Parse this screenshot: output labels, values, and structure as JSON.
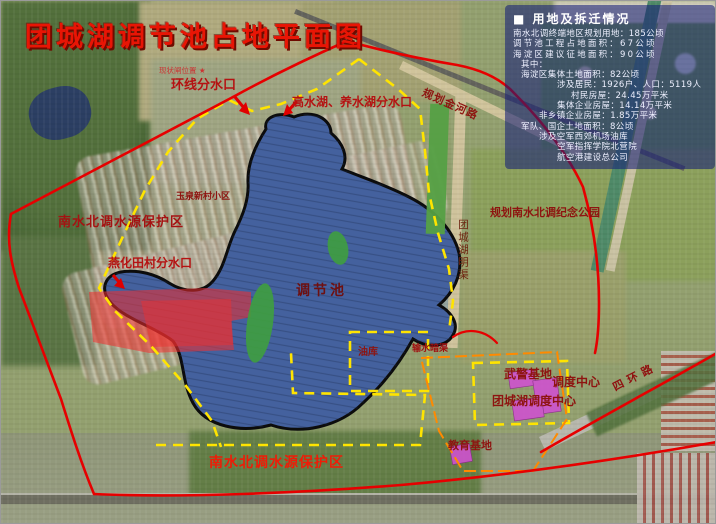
{
  "title": "团城湖调节池占地平面图",
  "legend": {
    "bullet": "■",
    "title": "用地及拆迁情况",
    "lines": [
      {
        "text": "南水北调终端地区规划用地：185公顷"
      },
      {
        "text": "调节池工程占地面积：67公顷"
      },
      {
        "text": "海淀区建议征地面积：90公顷"
      },
      {
        "text": "其中："
      },
      {
        "text": "海淀区集体土地面积：82公顷"
      },
      {
        "text": "涉及居民：1926户、人口：5119人"
      },
      {
        "text": "村民房屋：24.45万平米"
      },
      {
        "text": "集体企业房屋：14.14万平米"
      },
      {
        "text": "非乡镇企业房屋：1.85万平米"
      },
      {
        "text": "军队、国企土地面积：8公顷"
      },
      {
        "text": "涉及空军西郊机场油库"
      },
      {
        "text": "空军指挥学院北营院"
      },
      {
        "text": "航空港建设总公司"
      }
    ]
  },
  "map_labels": [
    {
      "id": "site-marker",
      "text": "现状闸位置 ★"
    },
    {
      "id": "huanxian-fenshuikou",
      "text": "环线分水口"
    },
    {
      "id": "gaoshuihu-fenshuikou",
      "text": "高水湖、养水湖分水口"
    },
    {
      "id": "jinhe-road",
      "text": "规划金河路"
    },
    {
      "id": "yuquan-xiaoqu",
      "text": "玉泉新村小区"
    },
    {
      "id": "baohuqu-nw",
      "text": "南水北调水源保护区"
    },
    {
      "id": "yanhua-fenshuikou",
      "text": "燕化田村分水口"
    },
    {
      "id": "tiaojiechi",
      "text": "调节池"
    },
    {
      "id": "jinian-park",
      "text": "规划南水北调纪念公园"
    },
    {
      "id": "mingqu",
      "text": "团城湖明渠"
    },
    {
      "id": "youku",
      "text": "油库"
    },
    {
      "id": "shushui-anqu",
      "text": "输水暗渠"
    },
    {
      "id": "wujing-jidi",
      "text": "武警基地"
    },
    {
      "id": "diaodu-center",
      "text": "调度中心"
    },
    {
      "id": "tuanchenghu-diaodu-center",
      "text": "团城湖调度中心"
    },
    {
      "id": "sihuan-road",
      "text": "四环路"
    },
    {
      "id": "jiaoyu-jidi",
      "text": "教育基地"
    },
    {
      "id": "baohuqu-south",
      "text": "南水北调水源保护区"
    }
  ],
  "colors": {
    "boundary_red": "#e60000",
    "dashed_yellow": "#ffe400",
    "pond_blue": "#44619e",
    "pond_outline": "#0c0c0c",
    "demolition_red": "#f22e2e",
    "greenery": "#3f9e3f",
    "building_magenta": "#cf52cf",
    "compound_orange": "#ff8a00",
    "label_dark_red": "#8e1410",
    "legend_bg_blue": "#141e76"
  }
}
